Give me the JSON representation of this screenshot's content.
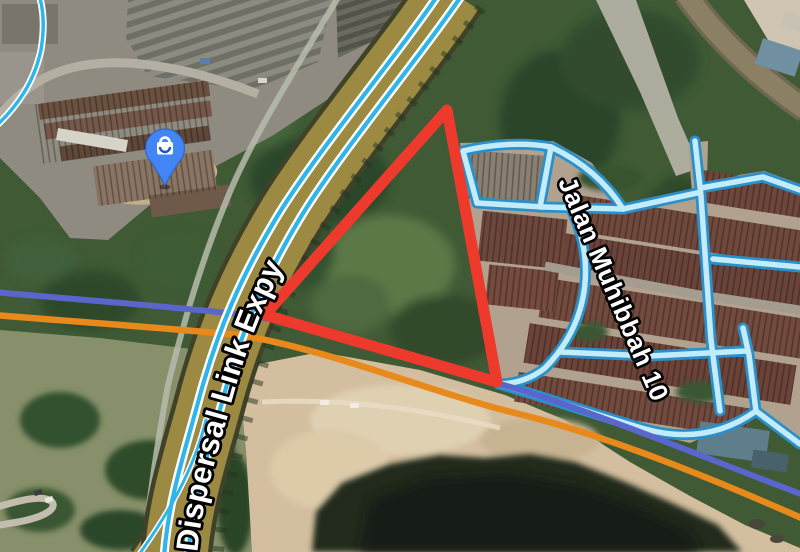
{
  "map": {
    "labels": {
      "expressway": "Dispersal Link Expy",
      "street": "Jalan Muhibbah 10"
    },
    "pin": {
      "kind": "shopping",
      "color": "#4285f4"
    },
    "overlay": {
      "parcel_outline_color": "#ee3a2d"
    },
    "lines": {
      "cycling_route": "#2fb5ea",
      "transit_blue": "#5a66cc",
      "transit_orange": "#e8891c"
    },
    "road": {
      "expressway_fill": "#9c8a42"
    }
  }
}
